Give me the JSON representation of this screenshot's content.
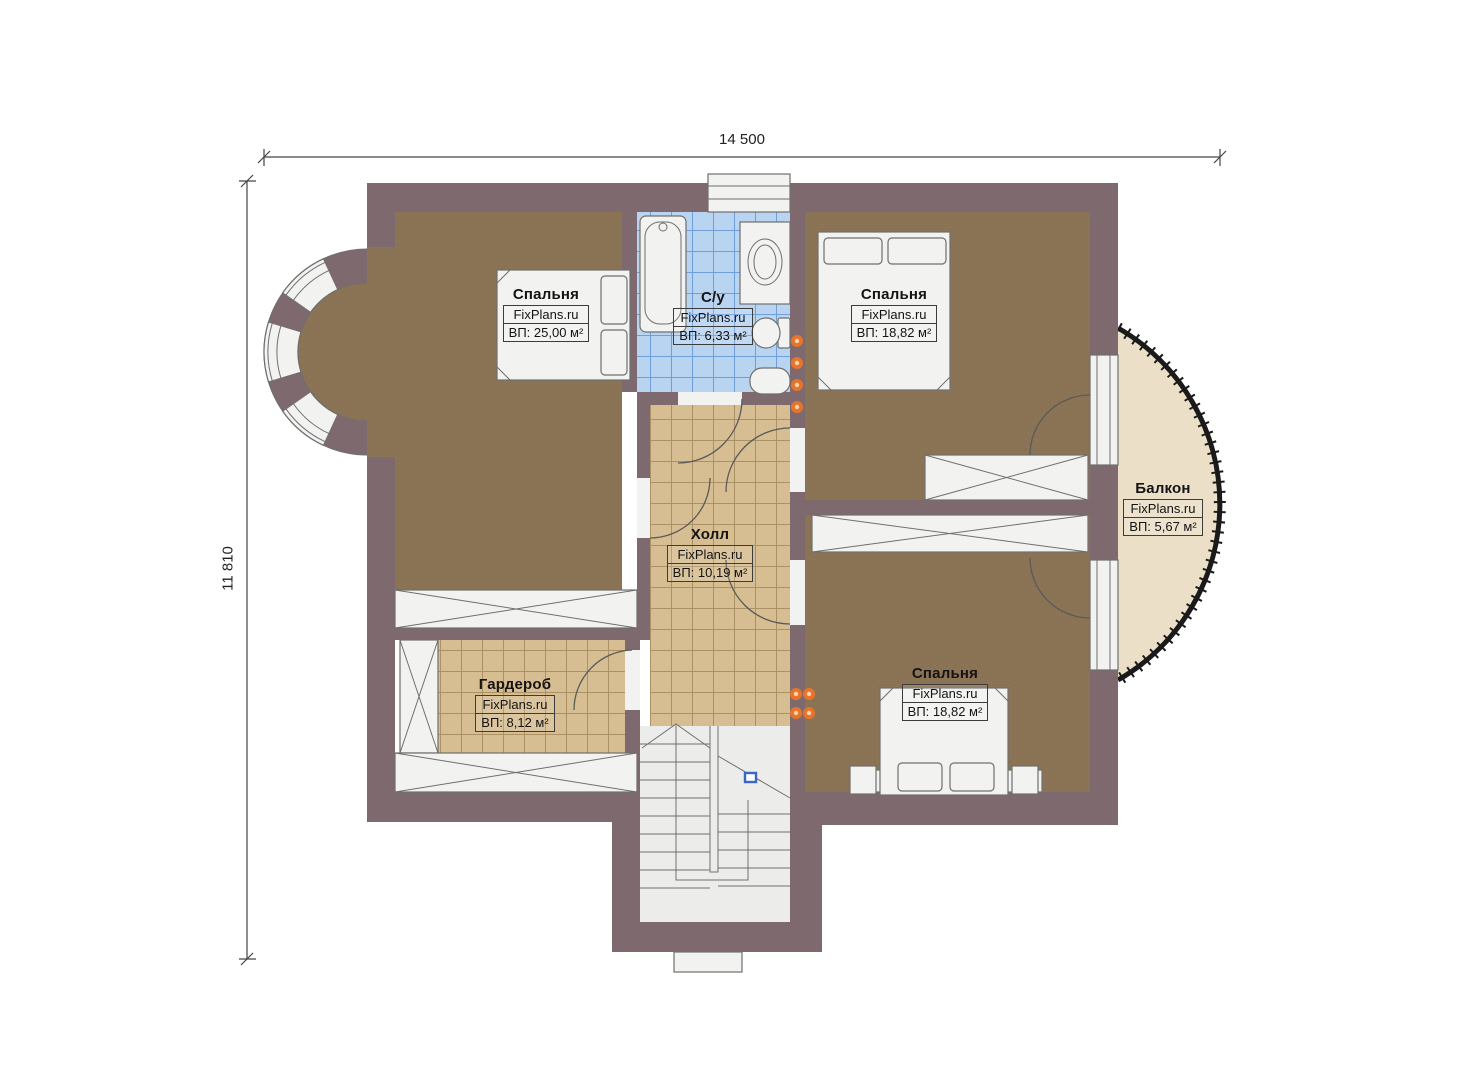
{
  "title": "Floor plan",
  "dimensions": {
    "top": "14 500",
    "left": "11 810"
  },
  "rooms": [
    {
      "id": "bedroom-tl",
      "name": "Спальня",
      "brand": "FixPlans.ru",
      "area": "ВП: 25,00 м²"
    },
    {
      "id": "bathroom",
      "name": "С/у",
      "brand": "FixPlans.ru",
      "area": "ВП: 6,33 м²"
    },
    {
      "id": "bedroom-tr",
      "name": "Спальня",
      "brand": "FixPlans.ru",
      "area": "ВП: 18,82 м²"
    },
    {
      "id": "hall",
      "name": "Холл",
      "brand": "FixPlans.ru",
      "area": "ВП: 10,19 м²"
    },
    {
      "id": "wardrobe",
      "name": "Гардероб",
      "brand": "FixPlans.ru",
      "area": "ВП: 8,12 м²"
    },
    {
      "id": "bedroom-br",
      "name": "Спальня",
      "brand": "FixPlans.ru",
      "area": "ВП: 18,82 м²"
    },
    {
      "id": "balcony",
      "name": "Балкон",
      "brand": "FixPlans.ru",
      "area": "ВП: 5,67 м²"
    }
  ],
  "colors": {
    "wall": "#7e6a6e",
    "carpet": "#8b7355",
    "carpet_dot": "#7a6347",
    "tile_tan": "#d6bd92",
    "tile_tan_line": "#ab9166",
    "tile_blue": "#b9d4f1",
    "tile_blue_line": "#6f9ed9",
    "balcony": "#ebdfc7",
    "fixture_white": "#f2f2f0",
    "stair_bg": "#ececea",
    "accent_orange": "#e8742c",
    "marker_blue": "#3a66c8"
  }
}
